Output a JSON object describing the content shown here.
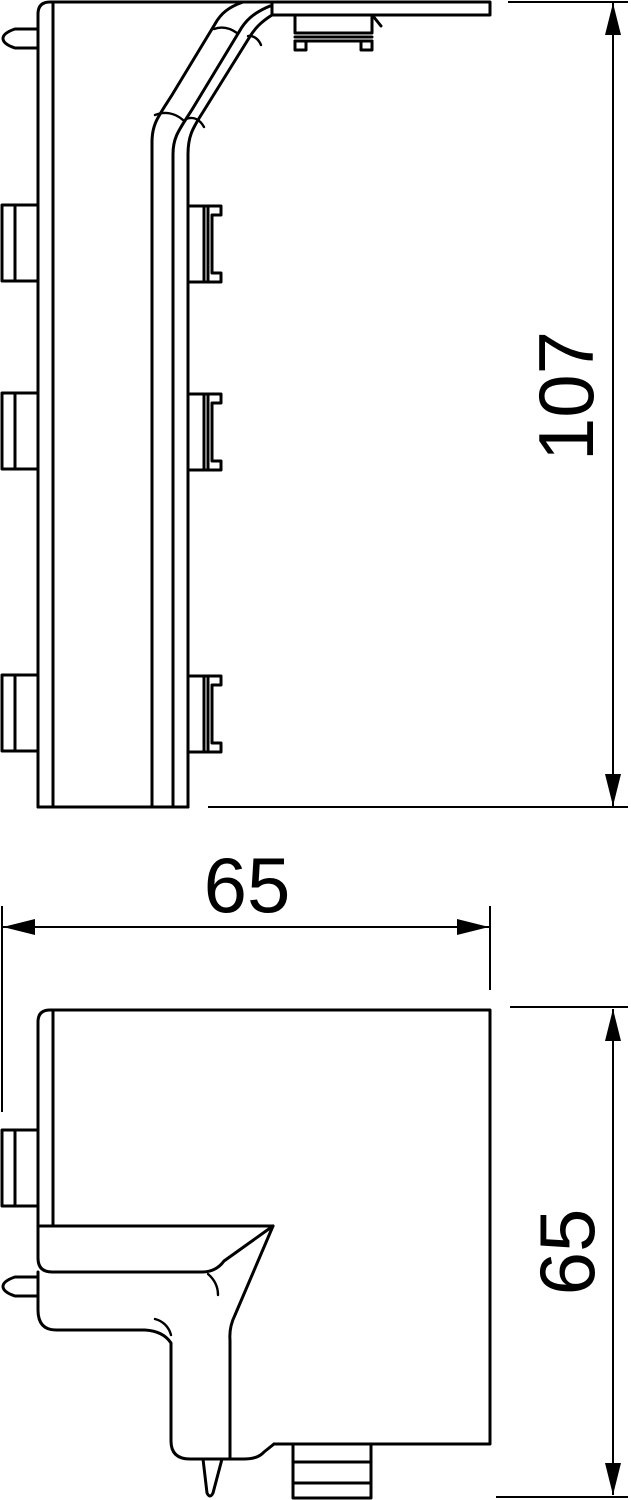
{
  "drawing": {
    "background_color": "#ffffff",
    "line_color": "#000000",
    "views": {
      "side_view": {
        "dimension_height": {
          "value": "107"
        }
      },
      "plan_view": {
        "dimension_width": {
          "value": "65"
        },
        "dimension_depth": {
          "value": "65"
        }
      }
    }
  }
}
